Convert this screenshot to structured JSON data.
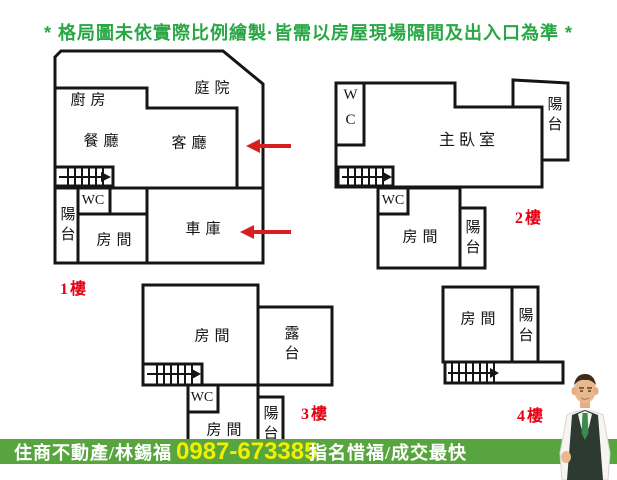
{
  "notice": "* 格局圖未依實際比例繪製·皆需以房屋現場隔間及出入口為準 *",
  "floors": {
    "f1": {
      "label": "1樓",
      "kitchen": "廚房",
      "courtyard": "庭院",
      "dining": "餐廳",
      "living": "客廳",
      "wc": "WC",
      "balcony": "陽台",
      "room": "房間",
      "garage": "車庫"
    },
    "f2": {
      "label": "2樓",
      "wc_upper": "WC",
      "master": "主臥室",
      "balcony_upper": "陽台",
      "wc": "WC",
      "room": "房間",
      "balcony": "陽台"
    },
    "f3": {
      "label": "3樓",
      "room_upper": "房間",
      "terrace": "露台",
      "wc": "WC",
      "room": "房間",
      "balcony": "陽台"
    },
    "f4": {
      "label": "4樓",
      "room": "房間",
      "balcony": "陽台"
    }
  },
  "banner": {
    "agency": "住商不動產/林錫福",
    "phone": "0987-673385",
    "slogan": "指名惜福/成交最快"
  },
  "icons": {
    "entrance_arrows": "red-left-arrow",
    "stairs": "hatched-stairs-right-arrow",
    "agent_photo": "real-estate-agent-portrait"
  },
  "colors": {
    "notice_green": "#28a744",
    "banner_green": "#58a53f",
    "phone_yellow": "#f2ef00",
    "label_red": "#e60012",
    "wall_black": "#151515",
    "arrow_red": "#d6201f"
  }
}
